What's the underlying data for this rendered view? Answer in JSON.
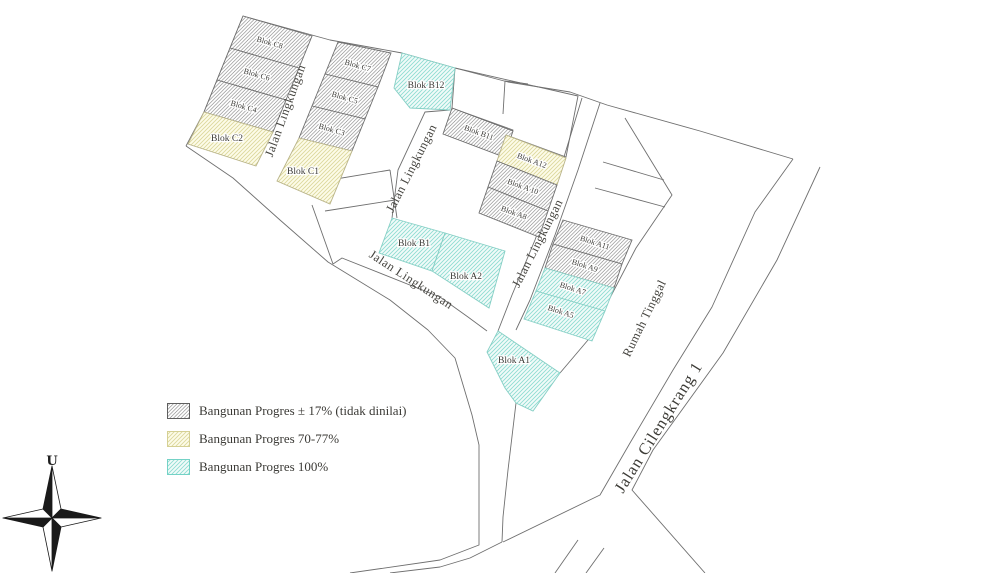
{
  "map": {
    "blocks": [
      {
        "id": "c8",
        "label": "Blok C8",
        "status": "progress_17"
      },
      {
        "id": "c6",
        "label": "Blok C6",
        "status": "progress_17"
      },
      {
        "id": "c4",
        "label": "Blok C4",
        "status": "progress_17"
      },
      {
        "id": "c2",
        "label": "Blok C2",
        "status": "progress_70_77"
      },
      {
        "id": "c7",
        "label": "Blok C7",
        "status": "progress_17"
      },
      {
        "id": "c5",
        "label": "Blok C5",
        "status": "progress_17"
      },
      {
        "id": "c3",
        "label": "Blok C3",
        "status": "progress_17"
      },
      {
        "id": "c1",
        "label": "Blok C1",
        "status": "progress_70_77"
      },
      {
        "id": "b12",
        "label": "Blok B12",
        "status": "progress_100"
      },
      {
        "id": "b11",
        "label": "Blok B11",
        "status": "progress_17"
      },
      {
        "id": "a12",
        "label": "Blok A12",
        "status": "progress_70_77"
      },
      {
        "id": "a10",
        "label": "Blok A 10",
        "status": "progress_17"
      },
      {
        "id": "a8",
        "label": "Blok A8",
        "status": "progress_17"
      },
      {
        "id": "b1",
        "label": "Blok B1",
        "status": "progress_100"
      },
      {
        "id": "a2",
        "label": "Blok A2",
        "status": "progress_100"
      },
      {
        "id": "a11",
        "label": "Blok A11",
        "status": "progress_17"
      },
      {
        "id": "a9",
        "label": "Blok A9",
        "status": "progress_17"
      },
      {
        "id": "a7",
        "label": "Blok A7",
        "status": "progress_100"
      },
      {
        "id": "a5",
        "label": "Blok A5",
        "status": "progress_100"
      },
      {
        "id": "a1",
        "label": "Blok A1",
        "status": "progress_100"
      }
    ],
    "road_labels": {
      "road1": "Jalan Lingkungan",
      "road2": "Jalan Lingkungan",
      "road3": "Jalan Lingkungan",
      "road4": "Jalan Lingkungan",
      "area": "Rumah Tinggal",
      "main_road": "Jalan Cilengkrang 1"
    }
  },
  "legend": {
    "items": [
      {
        "label": "Bangunan Progres ± 17% (tidak dinilai)",
        "fill": "#ffffff",
        "hatch": "#6e6e6e"
      },
      {
        "label": "Bangunan Progres 70-77%",
        "fill": "#fdfce9",
        "hatch": "#dcd79c"
      },
      {
        "label": "Bangunan Progres 100%",
        "fill": "#ecfaf7",
        "hatch": "#8edcd2"
      }
    ]
  },
  "compass": {
    "north_label": "U"
  }
}
